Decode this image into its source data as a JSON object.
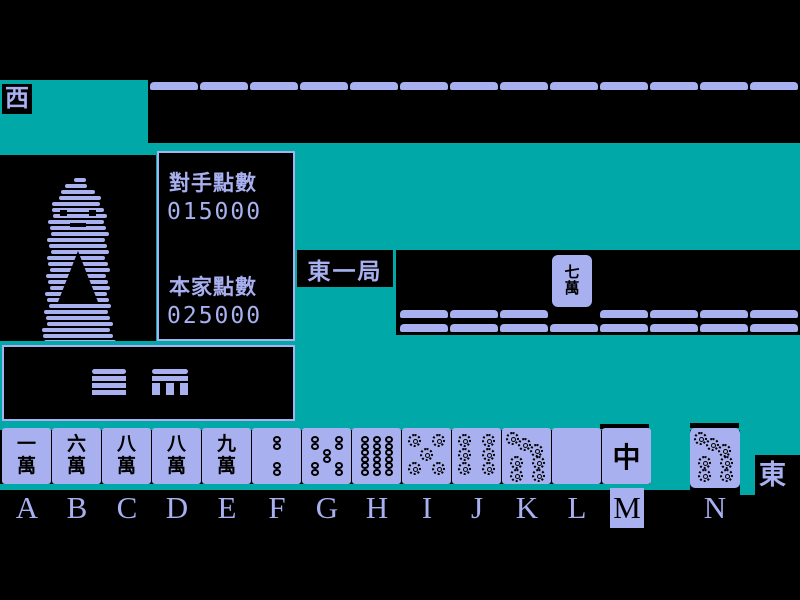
{
  "colors": {
    "teal": "#00a8a8",
    "tile": "#a8b0f0",
    "ink": "#000000"
  },
  "winds": {
    "left": "西",
    "right": "東"
  },
  "round": {
    "label": "東一局"
  },
  "scoreboard": {
    "opponent_label": "對手點數",
    "opponent_value": "015000",
    "self_label": "本家點數",
    "self_value": "025000"
  },
  "discard": {
    "tile": "七萬"
  },
  "walls": {
    "top_count": 13,
    "upper_left_count": 3,
    "upper_right_count": 4,
    "lower_count": 8
  },
  "hand": {
    "selected": "M",
    "tiles": [
      {
        "key": "A",
        "kind": "man",
        "text": "一萬"
      },
      {
        "key": "B",
        "kind": "man",
        "text": "六萬"
      },
      {
        "key": "C",
        "kind": "man",
        "text": "八萬"
      },
      {
        "key": "D",
        "kind": "man",
        "text": "八萬"
      },
      {
        "key": "E",
        "kind": "man",
        "text": "九萬"
      },
      {
        "key": "F",
        "kind": "sou",
        "value": 2
      },
      {
        "key": "G",
        "kind": "sou",
        "value": 5
      },
      {
        "key": "H",
        "kind": "sou",
        "value": 9
      },
      {
        "key": "I",
        "kind": "pin",
        "value": 5
      },
      {
        "key": "J",
        "kind": "pin",
        "value": 6
      },
      {
        "key": "K",
        "kind": "pin",
        "value": 7
      },
      {
        "key": "L",
        "kind": "blank",
        "text": ""
      },
      {
        "key": "M",
        "kind": "honor",
        "text": "中"
      }
    ],
    "drawn": {
      "key": "N",
      "kind": "pin",
      "value": 7
    }
  },
  "letters": [
    "A",
    "B",
    "C",
    "D",
    "E",
    "F",
    "G",
    "H",
    "I",
    "J",
    "K",
    "L",
    "M",
    "N"
  ]
}
